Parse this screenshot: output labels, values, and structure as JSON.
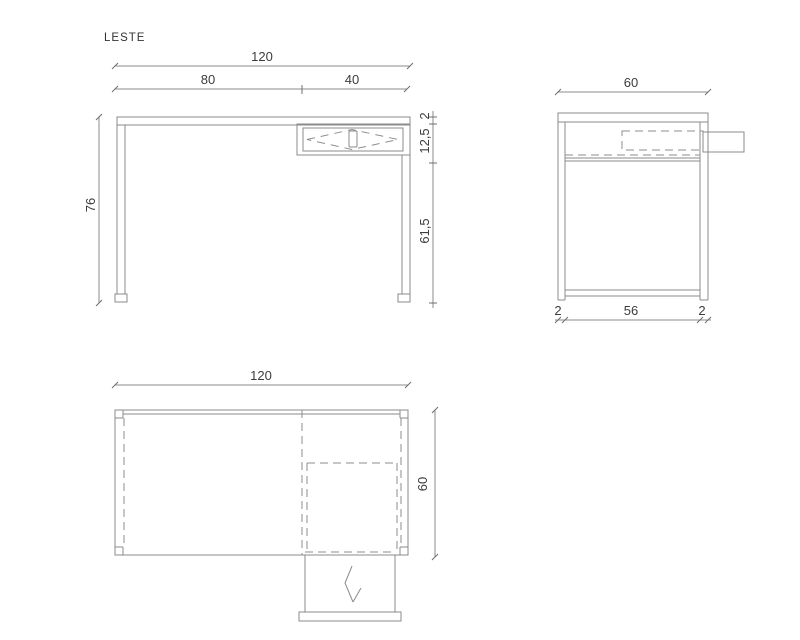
{
  "title": "LESTE",
  "colors": {
    "background": "#ffffff",
    "line": "#8b8b8b",
    "dashed_line": "#8e8e8e",
    "text": "#3c3c3c"
  },
  "front": {
    "total_width": "120",
    "left_width": "80",
    "right_width": "40",
    "height": "76",
    "top_thickness": "2",
    "drawer_height": "12,5",
    "under_drawer_height": "61,5"
  },
  "side": {
    "depth": "60",
    "front_leg": "2",
    "inner_depth": "56",
    "back_leg": "2"
  },
  "plan": {
    "width": "120",
    "depth": "60"
  }
}
